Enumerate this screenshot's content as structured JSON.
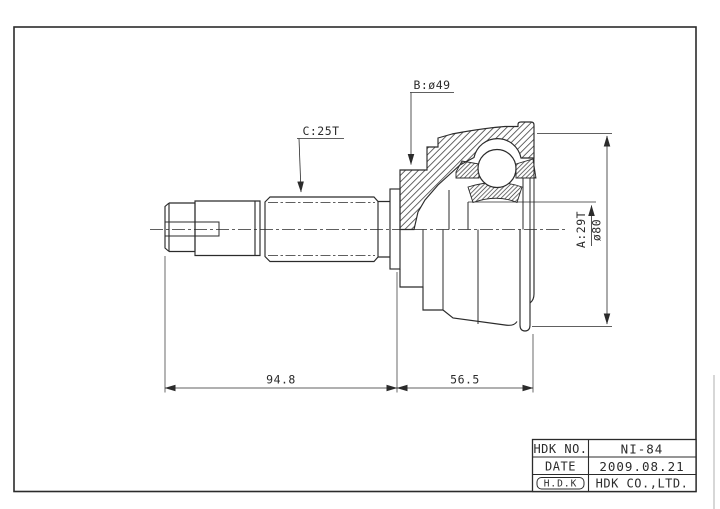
{
  "drawing": {
    "type": "cv-joint-outline-half-section",
    "colors": {
      "ink": "#2b2b2b",
      "paper": "#ffffff"
    },
    "dimensions": {
      "label_b": "B:ø49",
      "label_c": "C:25T",
      "label_a": "A:29T",
      "label_outer_dia": "ø80",
      "length_shaft": "94.8",
      "length_joint": "56.5"
    },
    "title_block": {
      "no_label": "HDK NO.",
      "no_value": "NI-84",
      "date_label": "DATE",
      "date_value": "2009.08.21",
      "logo": "H.D.K",
      "company": "HDK CO.,LTD."
    }
  }
}
